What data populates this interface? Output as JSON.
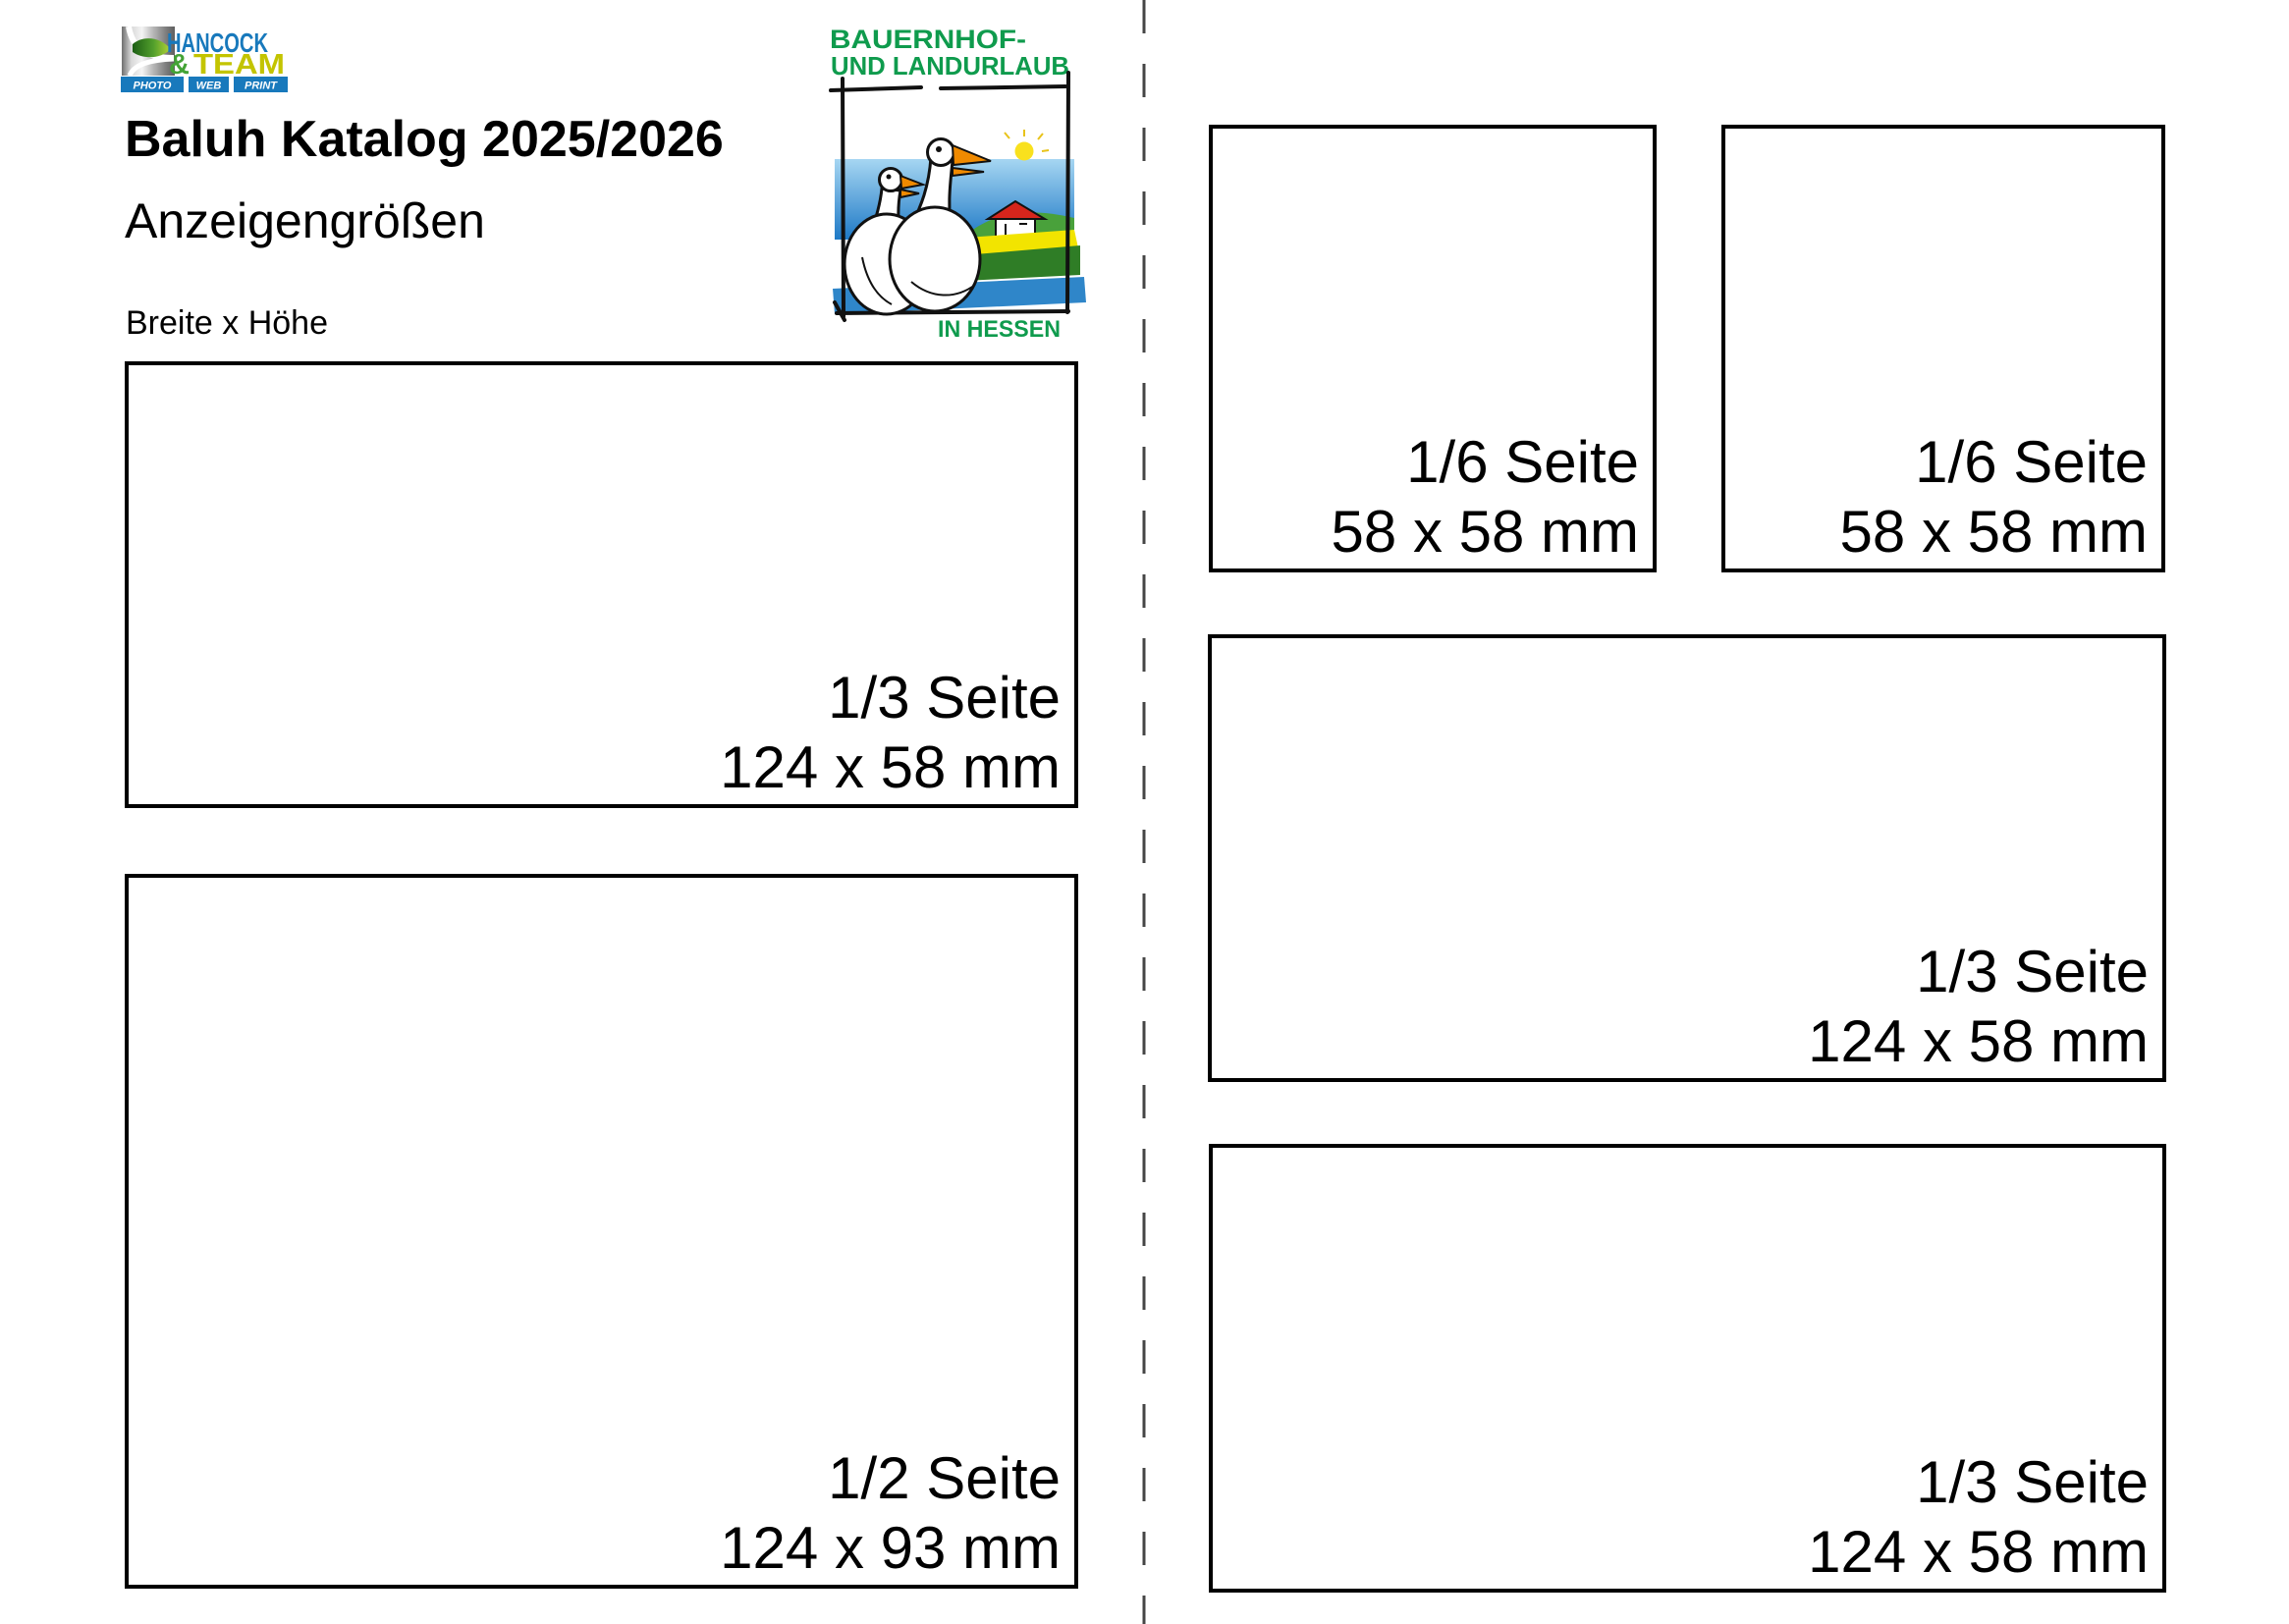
{
  "header": {
    "title": "Baluh Katalog 2025/2026",
    "subtitle": "Anzeigengrößen",
    "size_note": "Breite x Höhe"
  },
  "hancock_logo": {
    "name_line1": "HANCOCK",
    "ampersand": "&",
    "name_line2": "TEAM",
    "services": [
      "PHOTO",
      "WEB",
      "PRINT"
    ],
    "colors": {
      "blue": "#1879bc",
      "green": "#43a335",
      "yellow": "#c3c400"
    }
  },
  "baluh_logo": {
    "caption_line1": "BAUERNHOF-",
    "caption_line2": "UND LANDURLAUB",
    "caption_bottom": "IN HESSEN",
    "colors": {
      "green": "#0f9b4d",
      "sky_blue": "#2a7fc9",
      "field_yellow": "#f2e400",
      "hill_green": "#49a13b",
      "roof_red": "#d6251c",
      "beak_orange": "#f08a00"
    }
  },
  "divider": {
    "style": "dashed",
    "color": "#454545"
  },
  "ad_boxes": [
    {
      "label": "1/3 Seite",
      "dimensions": "124 x 58 mm"
    },
    {
      "label": "1/2 Seite",
      "dimensions": "124 x 93 mm"
    },
    {
      "label": "1/6 Seite",
      "dimensions": "58 x 58 mm"
    },
    {
      "label": "1/6 Seite",
      "dimensions": "58 x 58 mm"
    },
    {
      "label": "1/3 Seite",
      "dimensions": "124 x 58 mm"
    },
    {
      "label": "1/3 Seite",
      "dimensions": "124 x 58 mm"
    }
  ]
}
